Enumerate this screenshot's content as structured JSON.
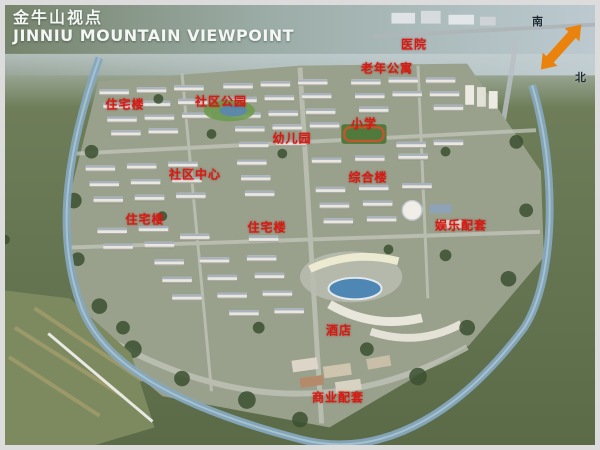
{
  "title": {
    "zh": "金牛山视点",
    "en": "JINNIU MOUNTAIN VIEWPOINT"
  },
  "compass": {
    "south": "南",
    "north": "北"
  },
  "map_labels": [
    {
      "text": "医院",
      "x": 409,
      "y": 39
    },
    {
      "text": "老年公寓",
      "x": 382,
      "y": 63
    },
    {
      "text": "住宅楼",
      "x": 120,
      "y": 99
    },
    {
      "text": "社区公园",
      "x": 216,
      "y": 96
    },
    {
      "text": "幼儿园",
      "x": 287,
      "y": 133
    },
    {
      "text": "小学",
      "x": 359,
      "y": 118
    },
    {
      "text": "社区中心",
      "x": 190,
      "y": 169
    },
    {
      "text": "综合楼",
      "x": 363,
      "y": 172
    },
    {
      "text": "住宅楼",
      "x": 140,
      "y": 214
    },
    {
      "text": "住宅楼",
      "x": 262,
      "y": 222
    },
    {
      "text": "娱乐配套",
      "x": 456,
      "y": 220
    },
    {
      "text": "酒店",
      "x": 334,
      "y": 325
    },
    {
      "text": "商业配套",
      "x": 333,
      "y": 392
    }
  ],
  "colors": {
    "label_red": "#d81a12",
    "title_white": "#f4f6f4",
    "compass_orange": "#ea820e",
    "water_blue": "#86a8be",
    "lake_blue": "#4e86b4"
  }
}
